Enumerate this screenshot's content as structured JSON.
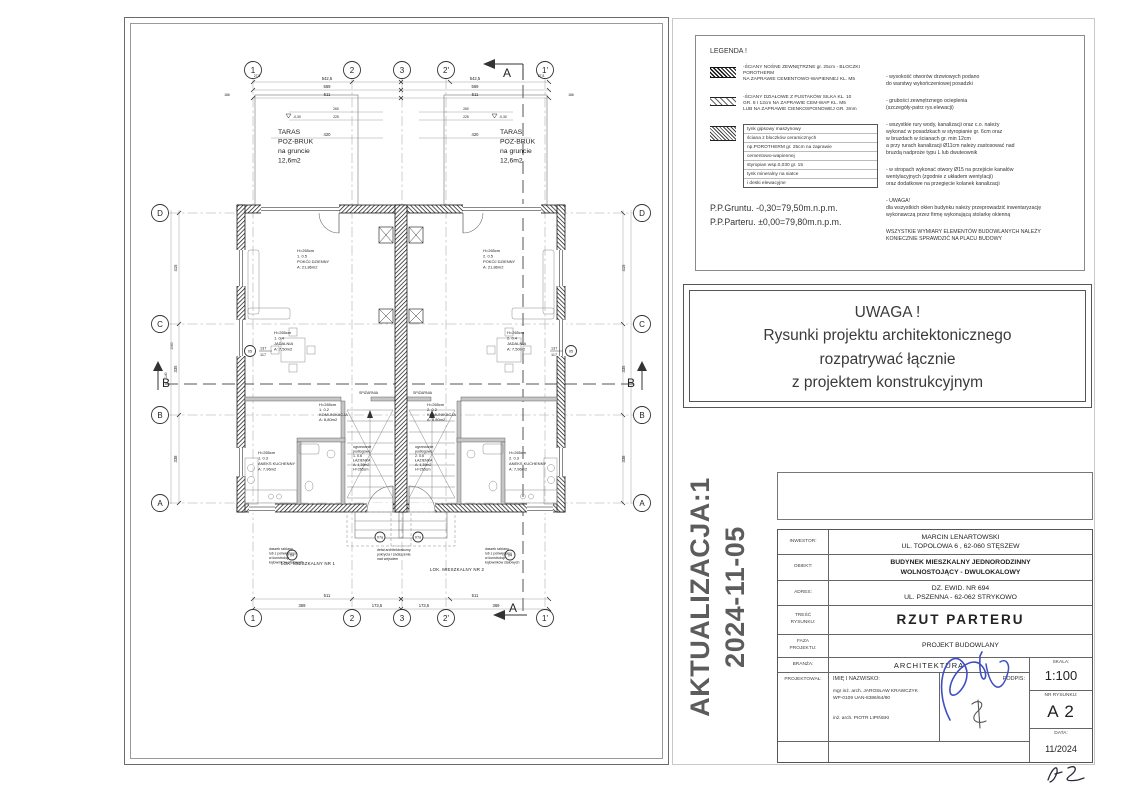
{
  "plan": {
    "grid_cols": {
      "c1": "1",
      "c2": "2",
      "c3": "3",
      "c4": "2'",
      "c5": "1'"
    },
    "grid_rows": {
      "rd": "D",
      "rc": "C",
      "rb": "B",
      "ra": "A"
    },
    "sections": {
      "a": "A",
      "b": "B"
    },
    "taras": {
      "l1": "TARAS",
      "l2": "POZ-BRUK",
      "l3": "na gruncie",
      "l4": "12,6m2"
    },
    "levels": {
      "terrace": "-0,30"
    },
    "dims": {
      "d5425": "542,5",
      "d569": "569",
      "d511": "511",
      "d260": "260",
      "d225": "225",
      "d420": "420",
      "d186": "186",
      "d275": "27,5",
      "d369": "369",
      "d1735": "173,5",
      "d511b": "511",
      "d415": "415",
      "d335": "335",
      "d338": "338",
      "d1140": "1140",
      "d1060": "1060"
    },
    "window_tag": {
      "code": "05",
      "num": "137",
      "den": "117"
    },
    "door_tags": {
      "outer": "04",
      "inner": "07a"
    },
    "rooms": {
      "h": "H=265cm",
      "pokoj": {
        "c1": "1. 0.5",
        "c2": "2. 0.5",
        "name": "POKÓJ DZIENNY",
        "area": "A: 21,86m2"
      },
      "jadalnia": {
        "c1": "1. 0.4",
        "c2": "2. 0.4",
        "name": "JADALNIA",
        "area": "A: 7,50m2"
      },
      "aneks": {
        "c1": "1. 0.3",
        "c2": "2. 0.3",
        "name": "ANEKS KUCHENNY",
        "area": "A: 7,96m2"
      },
      "lazienka": {
        "pre1": "ogrzewanie",
        "pre2": "podłogowe",
        "c1": "1. 0.6",
        "c2": "2. 0.6",
        "name": "ŁAZIENKA",
        "area": "A: 4,39m2"
      },
      "komunikacja": {
        "c1": "1. 0.2",
        "c2": "2. 0.2",
        "name": "KOMUNIKACJA",
        "area": "A: 8,80m2"
      },
      "spizarnia": "SPIŻARNIA",
      "lok1": "LOK. MIESZKALNY NR 1",
      "lok2": "LOK. MIESZKALNY NR 2"
    },
    "notes": {
      "daszek": {
        "l1": "daszek szklany",
        "l2": "lub z poliwęglanu",
        "l3": "w konstrukcji",
        "l4": "kątowników stalowych"
      },
      "detal": {
        "l1": "detal architektoniczny",
        "l2": "pokrycia i zadaszenia",
        "l3": "nad wejściem"
      }
    }
  },
  "legend": {
    "title": "LEGENDA !",
    "item1": {
      "l1": "-ŚCIANY NOŚNE ZEWNĘTRZNE gr. 25cm - BLOCZKI POROTHERM",
      "l2": " NA ZAPRAWIE CEMENTOWO-WAPIENNEJ  KL. M5"
    },
    "item2": {
      "l1": "-ŚCIANY DZIAŁOWE Z PUSTAKÓW SILKA KL. 10",
      "l2": " GR. 8 I 12cm NA ZAPRAWIE CEM-WAP KL. M5",
      "l3": " LUB NA ZAPRAWIE CIENKOSPOINOWEJ GR. 3mm"
    },
    "wall_layers": {
      "l1": "tynk gipsowy maszynowy",
      "l2": "ściana z bloczków ceramicznych",
      "l3": "np.POROTHERM gr. 25cm na zaprawie",
      "l4": "cementowo-wapiennej",
      "l5": "styropian wsp.0,030 gr. 15",
      "l6": "tynk mineralny na siatce",
      "l7": "i deski elewacyjne"
    },
    "pp1": "P.P.Gruntu. -0,30=79,50m.n.p.m.",
    "pp2": "P.P.Parteru. ±0,00=79,80m.n.p.m.",
    "notes": [
      [
        "- wysokość otworów drzwiowych podano",
        "  do warstwy wykończeniowej posadzki"
      ],
      [
        "- grubości zewnętrznego ocieplenia",
        "  (szczegóły-patrz rys.elewacji)"
      ],
      [
        "- wszystkie rury wody, kanalizacji oraz c.o. należy",
        "  wykonać w posadzkach w styropianie gr. 6cm oraz",
        "  w bruzdach w ścianach gr. min 12cm",
        "  a przy rurach kanalizacji Ø11cm należy zastosować nad",
        "  bruzdą nadproże typu L lub dwuteownik"
      ],
      [
        "- w stropach wykonać otwory Ø15 na przejście kanałów",
        "  wentylacyjnych (zgodnie z układem wentylacji)",
        "  oraz dodatkowe na przegięcie kolanek kanalizacji"
      ],
      [
        "- UWAGA!",
        "  dla wszystkich okien budynku należy przeprowadzić inwentaryzację",
        "  wykonawczą przez firmę wykonującą stolarkę okienną"
      ],
      [
        "WSZYSTKIE WYMIARY ELEMENTÓW BUDOWLANYCH NALEŻY",
        "KONIECZNIE SPRAWDZIĆ NA PLACU BUDOWY"
      ]
    ]
  },
  "uwaga": {
    "l1": "UWAGA !",
    "l2": "Rysunki projektu architektonicznego",
    "l3": "rozpatrywać łącznie",
    "l4": "z projektem konstrukcyjnym"
  },
  "aktualizacja": {
    "l1": "AKTUALIZACJA:1",
    "l2": "2024-11-05"
  },
  "titleblock": {
    "inwestor_label": "INWESTOR:",
    "inwestor1": "MARCIN  LENARTOWSKI",
    "inwestor2": "UL. TOPOLOWA 6 , 62-060 STĘSZEW",
    "obiekt_label": "OBIEKT:",
    "obiekt1": "BUDYNEK MIESZKALNY JEDNORODZINNY",
    "obiekt2": "WOLNOSTOJĄCY - DWULOKALOWY",
    "adres_label": "ADRES:",
    "adres1": "DZ. EWID. NR 694",
    "adres2": "UL. PSZENNA -  62-062 STRYKOWO",
    "tresc_label1": "TREŚĆ",
    "tresc_label2": "RYSUNKU:",
    "tresc": "RZUT  PARTERU",
    "faza_label1": "FAZA",
    "faza_label2": "PROJEKTU:",
    "faza": "PROJEKT BUDOWLANY",
    "branza_label": "BRANŻA:",
    "branza": "ARCHITEKTURA",
    "proj_label": "PROJEKTOWAŁ:",
    "imie_label": "IMIĘ I NAZWISKO:",
    "podpis_label": "PODPIS:",
    "arch1a": "mgr inż. arch. JAROSŁAW KRAWCZYK",
    "arch1b": "WP-0109  UAN-8386/64/90",
    "arch2": "inż. arch. PIOTR LIPIŃSKI",
    "skala_label": "SKALA:",
    "skala": "1:100",
    "nr_label": "NR RYSUNKU:",
    "nr": "A 2",
    "data_label": "DATA:",
    "data": "11/2024"
  }
}
